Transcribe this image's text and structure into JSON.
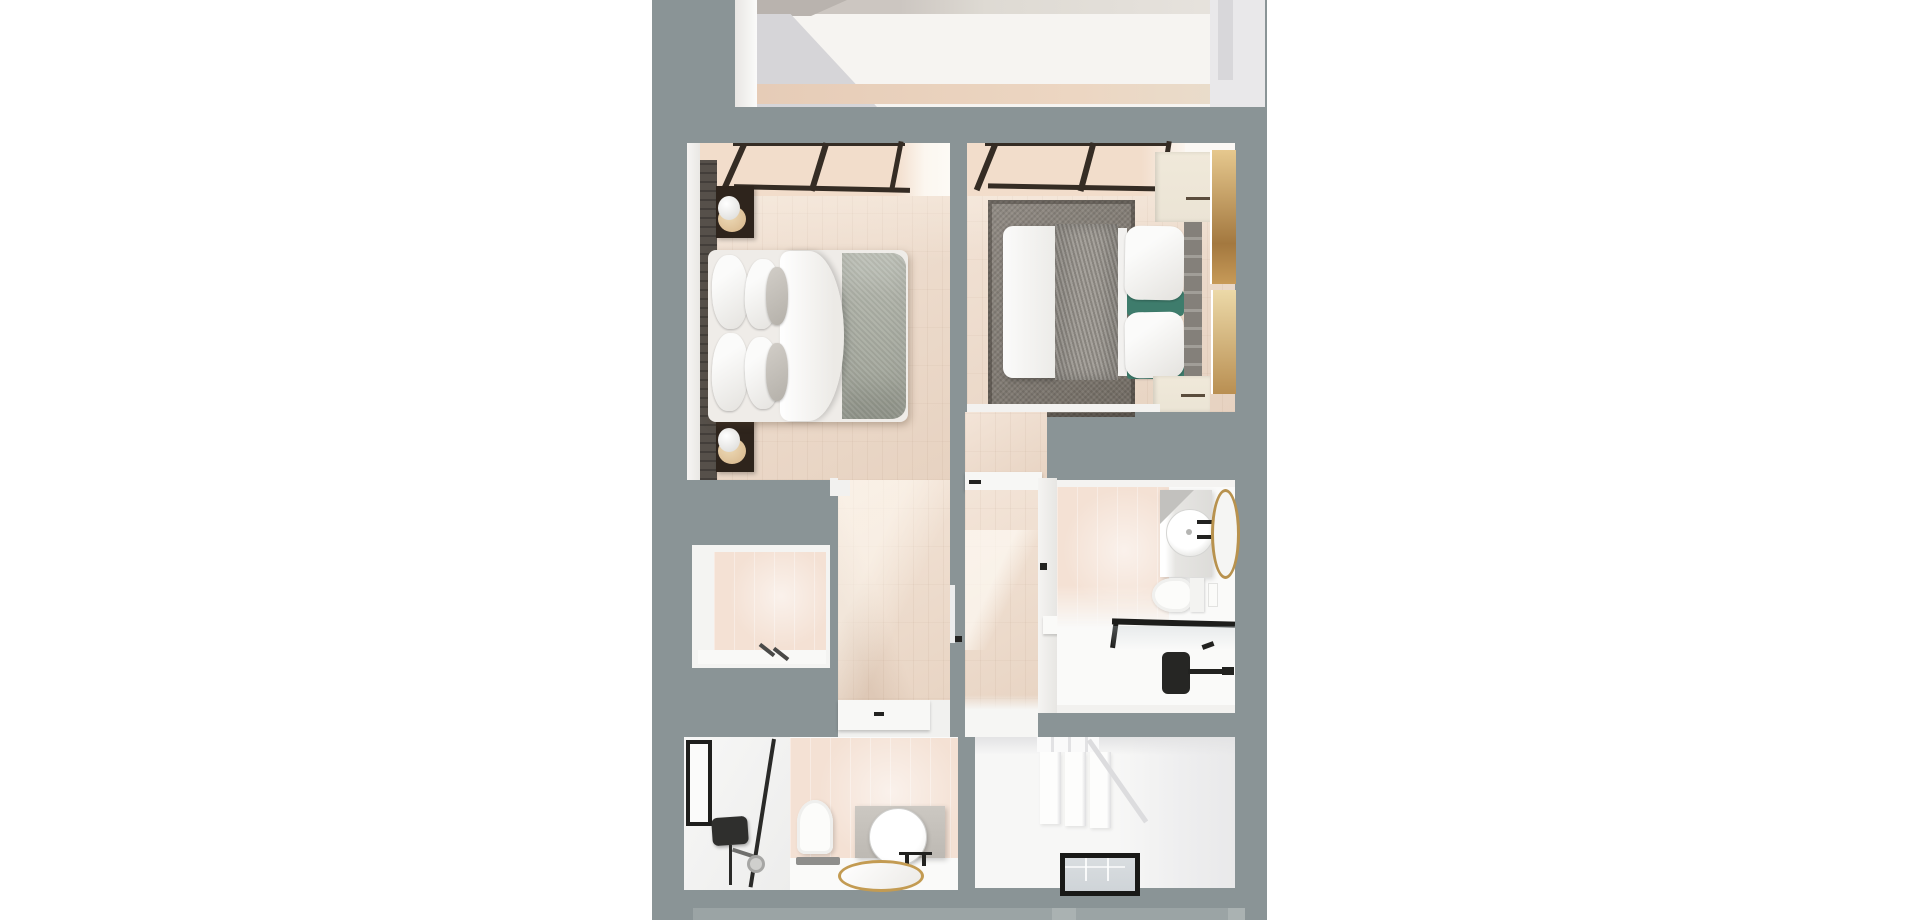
{
  "meta": {
    "title": "Top-down 3D render of a two-bedroom apartment floor plan",
    "view": "dollhouse top view, white page background",
    "visible_text": "none"
  },
  "colors": {
    "page_bg": "#ffffff",
    "wall": "#8a9496",
    "wall_light": "#9ba4a5",
    "wall_edge": "#f2f1ef",
    "wood_floor": "#eed9c7",
    "wood_sunlit": "#f6e6d6",
    "tile_pink": "#f4e1d4",
    "white_floor": "#f7f7f6",
    "window_frame": "#352c24",
    "headboard_wall": "#56504a",
    "nightstand_dark": "#2e241c",
    "duvet_white": "#f5f4f2",
    "comforter_sage": "#a7ab9f",
    "throw_gray": "#97938c",
    "pillow_teal": "#3e7c6c",
    "rug_taupe": "#7b746b",
    "cabinet_cream": "#ebe4d5",
    "art_gold": "#c79a58",
    "fixture_black": "#222220",
    "mirror_gold": "#b8924e",
    "vanity_concrete": "#bdb9b3",
    "lamp_tan": "#d6b488"
  },
  "rooms": {
    "upper_room": {
      "name": "Adjacent room (cropped at top edge)"
    },
    "bedroom1": {
      "name": "Bedroom 1 (left)",
      "furniture": [
        "double bed with white duvet and sage comforter",
        "white and gray pillows",
        "dark stone headboard wall",
        "two dark nightstands with globe lamps",
        "black-framed picture windows",
        "wood floor"
      ]
    },
    "bedroom2": {
      "name": "Bedroom 2 (right)",
      "furniture": [
        "double bed with gray knit throw",
        "white pillows with teal accents",
        "upholstered headboard",
        "taupe area rug",
        "cream wardrobe and dresser",
        "two gold wall artworks",
        "black-framed picture windows",
        "wood floor"
      ]
    },
    "closet": {
      "name": "Storage closet",
      "furniture": [
        "pink tiled back wall",
        "dark handles"
      ]
    },
    "hallway": {
      "name": "Hallway",
      "furniture": [
        "white door to lower bathroom",
        "wood floor"
      ]
    },
    "inner_hall": {
      "name": "Inner vestibule",
      "furniture": [
        "door to bedroom 2",
        "door to en-suite bathroom",
        "door to hallway",
        "wood floor"
      ]
    },
    "bathroom_right": {
      "name": "En-suite bathroom",
      "furniture": [
        "vanity with round vessel sink",
        "oval gold-framed mirror",
        "black faucet",
        "toilet with flush plate",
        "walk-in shower with black frame and fixtures",
        "pink tile and white floor"
      ]
    },
    "stairwell": {
      "name": "Stairwell / landing",
      "furniture": [
        "white staircase steps",
        "black-framed glass floor opening"
      ]
    },
    "bathroom_lower": {
      "name": "Lower bathroom",
      "furniture": [
        "walk-in shower with black glass frame and black shower head",
        "toilet with dark mat",
        "concrete vanity with round mirror",
        "gold-rimmed oval basin",
        "pink tiled wall"
      ]
    }
  }
}
